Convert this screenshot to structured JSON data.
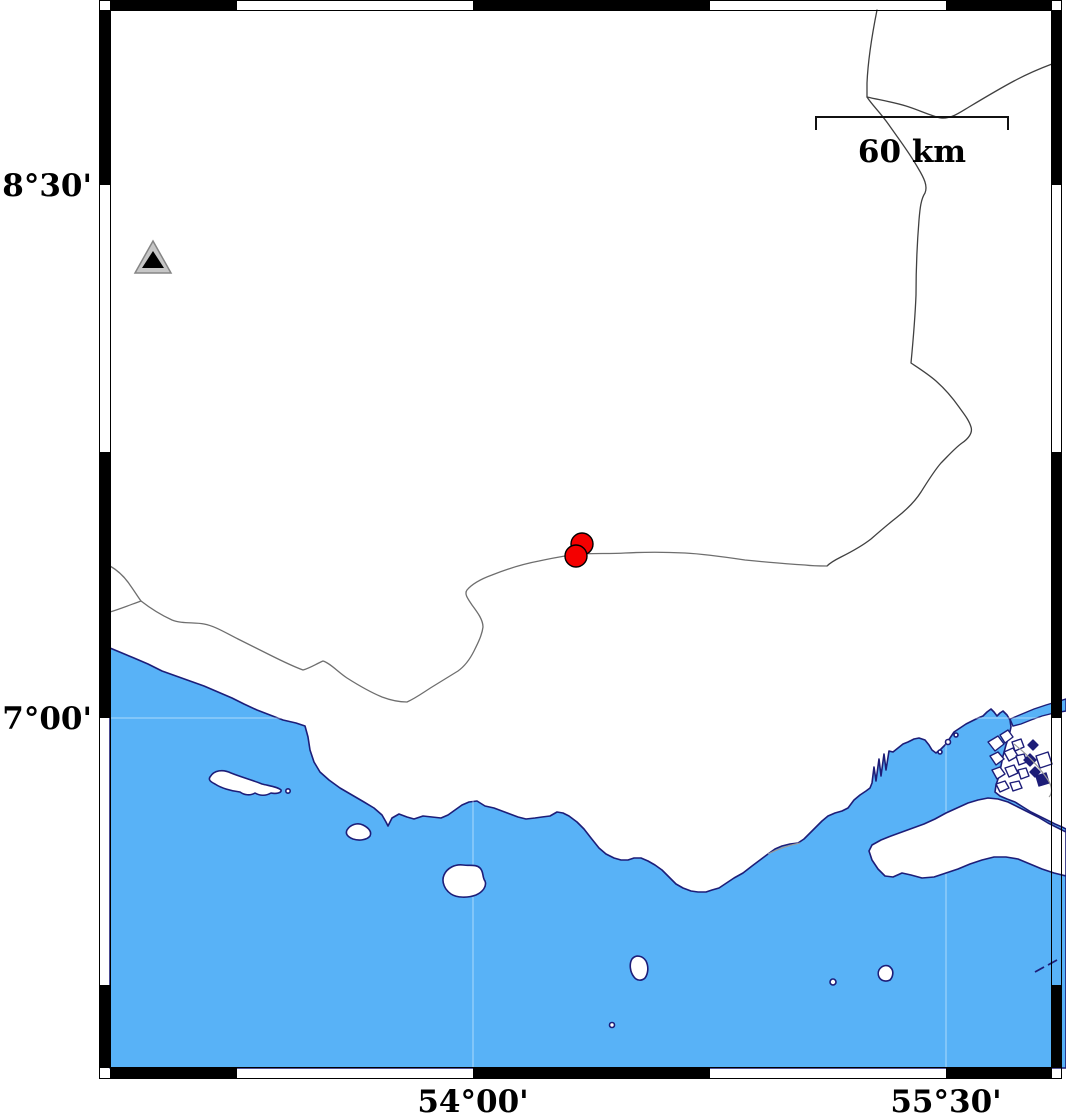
{
  "map": {
    "title": "coastal seismicity map",
    "labels": {
      "lat_top": "28°30'",
      "lat_bottom": "27°00'",
      "lon_left": "54°00'",
      "lon_right": "55°30'"
    },
    "scalebar": {
      "label": "60 km"
    },
    "markers": {
      "station": {
        "x": 153,
        "y": 258
      },
      "earthquake_radius": 11,
      "earthquakes": [
        {
          "x": 582,
          "y": 544
        },
        {
          "x": 576,
          "y": 556
        }
      ]
    },
    "colors": {
      "sea": "#58B2F7",
      "coastline": "#1D1D78",
      "eq_fill": "#F40000",
      "eq_stroke": "#000000",
      "station_fill": "#C6C6C6",
      "station_stroke": "#858585",
      "station_inner": "#000000",
      "road": "#404040",
      "secondary_road": "#6E6E6E",
      "border_gray": "#999999",
      "frame": "#000000",
      "grid": "rgba(255,255,255,0.5)"
    }
  }
}
